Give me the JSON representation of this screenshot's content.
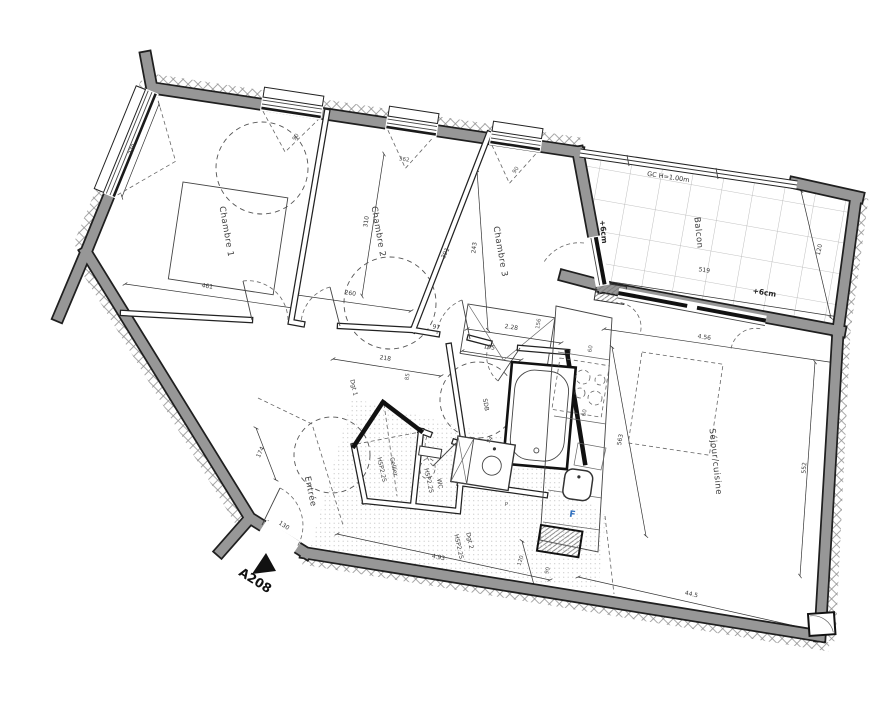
{
  "rooms": {
    "chambre1": "Chambre 1",
    "chambre2": "Chambre 2",
    "chambre3": "Chambre 3",
    "balcon": "Balcon",
    "sejour": "Séjour/cuisine",
    "entree": "Entrée",
    "cellier": "Cellier",
    "wc": "WC",
    "sdb": "SDB",
    "dgt1": "Dgt 1",
    "dgt2": "Dgt 2",
    "hsp": "HSP2.25"
  },
  "annotations": {
    "guardrail": "GC H=1.00m",
    "level_left": "+6cm",
    "level_bottom": "+6cm",
    "fridge": "F",
    "placard": "P",
    "unit": "A208"
  },
  "dims": {
    "d370": "370",
    "d461": "461",
    "d260": "260",
    "d310": "310",
    "d391": "391",
    "d243": "243",
    "d362": "362",
    "d90a": "90",
    "d90b": "90",
    "d97": "97",
    "d218": "218",
    "d85": "85",
    "d195": "195",
    "d228": "2.28",
    "d156": "156",
    "d94": "94",
    "d563": "563",
    "d456": "4.56",
    "d552": "552",
    "d445": "44.5",
    "d493": "4.93",
    "d120d": "120",
    "d90d": "90",
    "d130": "130",
    "d174": "174",
    "d519": "519",
    "d120b": "120",
    "d60a": "60",
    "d60b": "60"
  }
}
